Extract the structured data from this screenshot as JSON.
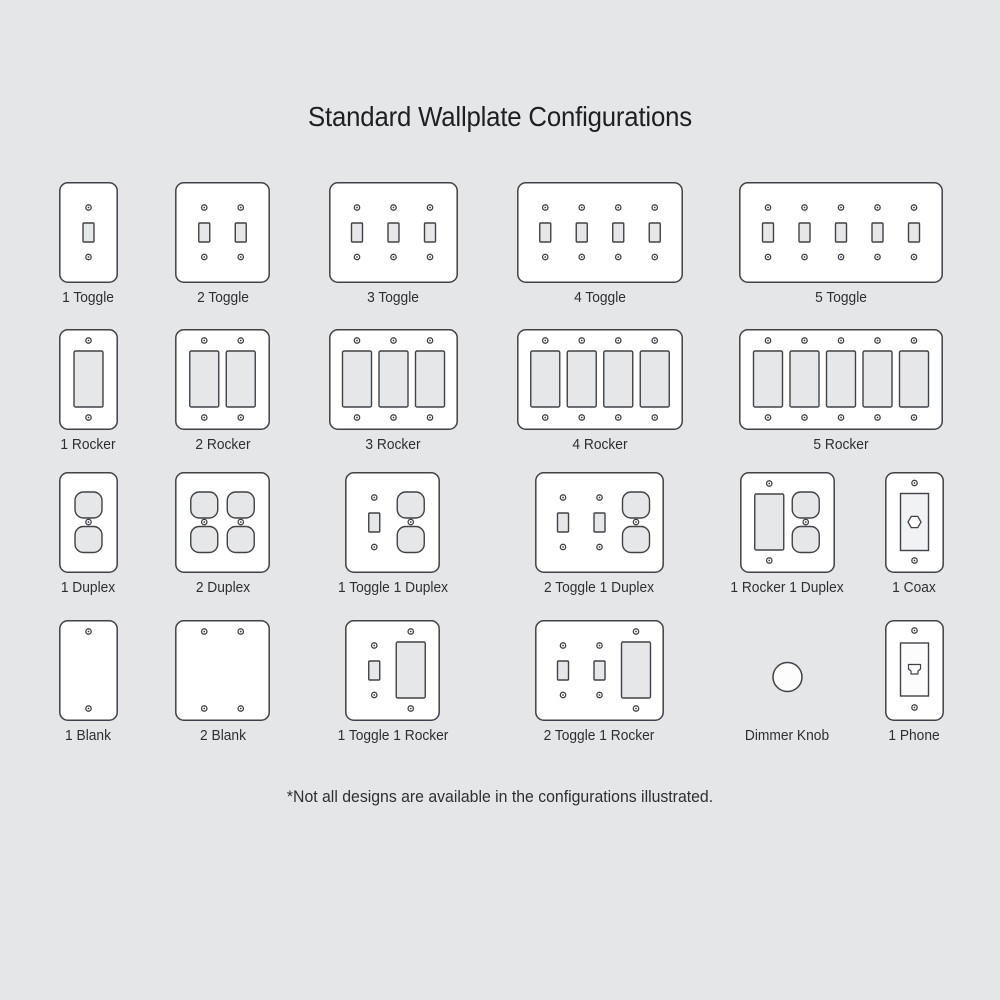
{
  "title": "Standard Wallplate Configurations",
  "footnote": "*Not all designs are available in the configurations illustrated.",
  "colors": {
    "background": "#e5e6e8",
    "plate_fill": "#ffffff",
    "outline": "#404247",
    "device_fill": "#e6e7e9",
    "jack_plate_fill": "#f1f2f4",
    "phone_plate_fill": "#fcfcfd",
    "text": "#2e2f31",
    "title_text": "#1e1f21"
  },
  "rows": [
    {
      "items": [
        {
          "label": "1 Toggle",
          "devices": [
            "toggle"
          ],
          "plate": true
        },
        {
          "label": "2 Toggle",
          "devices": [
            "toggle",
            "toggle"
          ],
          "plate": true
        },
        {
          "label": "3 Toggle",
          "devices": [
            "toggle",
            "toggle",
            "toggle"
          ],
          "plate": true
        },
        {
          "label": "4 Toggle",
          "devices": [
            "toggle",
            "toggle",
            "toggle",
            "toggle"
          ],
          "plate": true
        },
        {
          "label": "5 Toggle",
          "devices": [
            "toggle",
            "toggle",
            "toggle",
            "toggle",
            "toggle"
          ],
          "plate": true
        }
      ]
    },
    {
      "items": [
        {
          "label": "1 Rocker",
          "devices": [
            "rocker"
          ],
          "plate": true
        },
        {
          "label": "2 Rocker",
          "devices": [
            "rocker",
            "rocker"
          ],
          "plate": true
        },
        {
          "label": "3 Rocker",
          "devices": [
            "rocker",
            "rocker",
            "rocker"
          ],
          "plate": true
        },
        {
          "label": "4 Rocker",
          "devices": [
            "rocker",
            "rocker",
            "rocker",
            "rocker"
          ],
          "plate": true
        },
        {
          "label": "5 Rocker",
          "devices": [
            "rocker",
            "rocker",
            "rocker",
            "rocker",
            "rocker"
          ],
          "plate": true
        }
      ]
    },
    {
      "items": [
        {
          "label": "1 Duplex",
          "devices": [
            "duplex"
          ],
          "plate": true
        },
        {
          "label": "2 Duplex",
          "devices": [
            "duplex",
            "duplex"
          ],
          "plate": true
        },
        {
          "label": "1 Toggle 1 Duplex",
          "devices": [
            "toggle",
            "duplex"
          ],
          "plate": true
        },
        {
          "label": "2 Toggle 1 Duplex",
          "devices": [
            "toggle",
            "toggle",
            "duplex"
          ],
          "plate": true
        },
        {
          "label": "1 Rocker 1 Duplex",
          "devices": [
            "rocker",
            "duplex"
          ],
          "plate": true
        },
        {
          "label": "1 Coax",
          "devices": [
            "coax"
          ],
          "plate": true
        }
      ]
    },
    {
      "items": [
        {
          "label": "1 Blank",
          "devices": [
            "blank"
          ],
          "plate": true
        },
        {
          "label": "2 Blank",
          "devices": [
            "blank",
            "blank"
          ],
          "plate": true
        },
        {
          "label": "1 Toggle 1 Rocker",
          "devices": [
            "toggle",
            "rocker"
          ],
          "plate": true
        },
        {
          "label": "2 Toggle 1 Rocker",
          "devices": [
            "toggle",
            "toggle",
            "rocker"
          ],
          "plate": true
        },
        {
          "label": "Dimmer Knob",
          "devices": [
            "knob"
          ],
          "plate": false
        },
        {
          "label": "1 Phone",
          "devices": [
            "phone"
          ],
          "plate": true
        }
      ]
    }
  ]
}
